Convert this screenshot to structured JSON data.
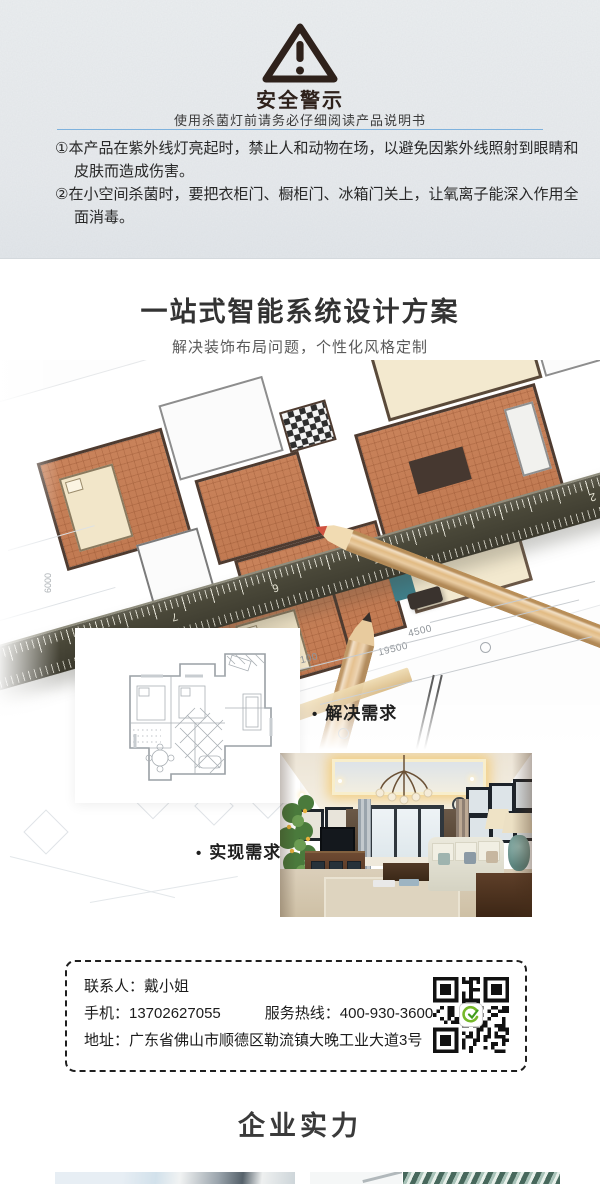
{
  "warning": {
    "title": "安全警示",
    "subtitle": "使用杀菌灯前请务必仔细阅读产品说明书",
    "items": [
      {
        "num": "①",
        "text": "本产品在紫外线灯亮起时，禁止人和动物在场，以避免因紫外线照射到眼睛和皮肤而造成伤害。"
      },
      {
        "num": "②",
        "text": "在小空间杀菌时，要把衣柜门、橱柜门、冰箱门关上，让氧离子能深入作用全面消毒。"
      }
    ]
  },
  "design": {
    "title": "一站式智能系统设计方案",
    "subtitle": "解决装饰布局问题，个性化风格定制",
    "bullet_solve": "解决需求",
    "bullet_realize": "实现需求",
    "blueprint_annotations": {
      "dim_a": "4500",
      "dim_b": "19500",
      "dim_c": "5100",
      "dim_d": "6000",
      "ruler_numbers": [
        "7",
        "6",
        "5",
        "2"
      ]
    }
  },
  "contact": {
    "person": "联系人：戴小姐",
    "mobile": "手机：13702627055",
    "hotline": "服务热线：400-930-3600",
    "address": "地址：广东省佛山市顺德区勒流镇大晚工业大道3号",
    "qr_icon": "wechat-qr-code"
  },
  "company": {
    "title": "企业实力"
  },
  "colors": {
    "accent_line": "#7fb2dd",
    "warning_dark": "#2e211b",
    "title_dark": "#333333",
    "subtitle_gray": "#595959",
    "plan_orange": "#c8825a",
    "ruler_dark": "#45433a",
    "qr_logo_green": "#76b82a"
  }
}
